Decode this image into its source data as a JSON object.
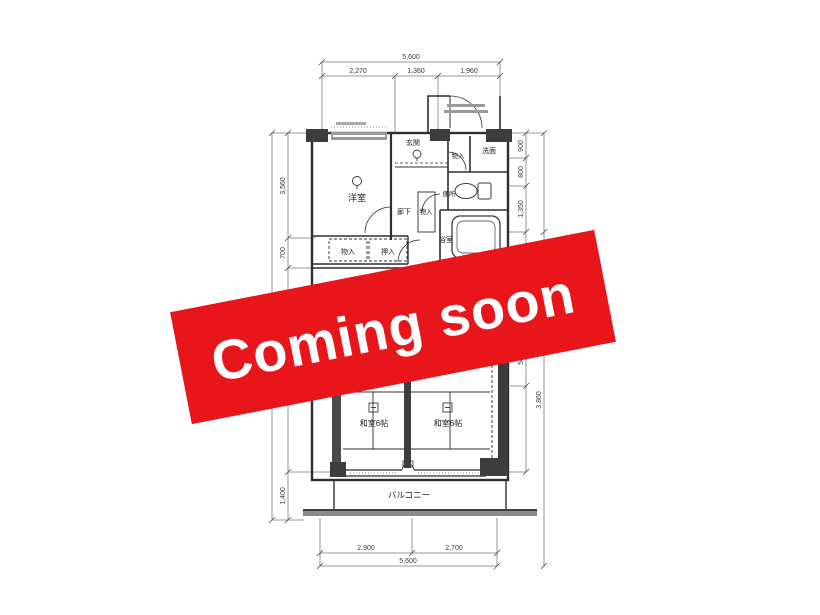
{
  "banner": {
    "text": "Coming soon",
    "background_color": "#e8151a",
    "text_color": "#ffffff"
  },
  "floorplan": {
    "labels": {
      "western_room": "洋室",
      "entrance": "玄関",
      "entrance_storage": "物入",
      "washroom": "洗面",
      "toilet": "便所",
      "hallway": "廊下",
      "hall_storage": "物入",
      "bath": "浴室",
      "washstand": "洗面",
      "closet_a": "物入",
      "closet_b": "押入",
      "closet_lower": "押入",
      "tatami_left": "和室6帖",
      "tatami_right": "和室6帖",
      "balcony": "バルコニー"
    },
    "dimensions": {
      "top_total": "5,600",
      "top_segments": [
        "2,270",
        "1,360",
        "1,960"
      ],
      "bottom_segments": [
        "2,900",
        "2,700"
      ],
      "bottom_total": "5,600",
      "left_segments": [
        "3,560",
        "700",
        "3,850",
        "1,400"
      ],
      "right_segments": [
        "900",
        "800",
        "1,350",
        "500"
      ],
      "right_total": "3,860"
    }
  }
}
